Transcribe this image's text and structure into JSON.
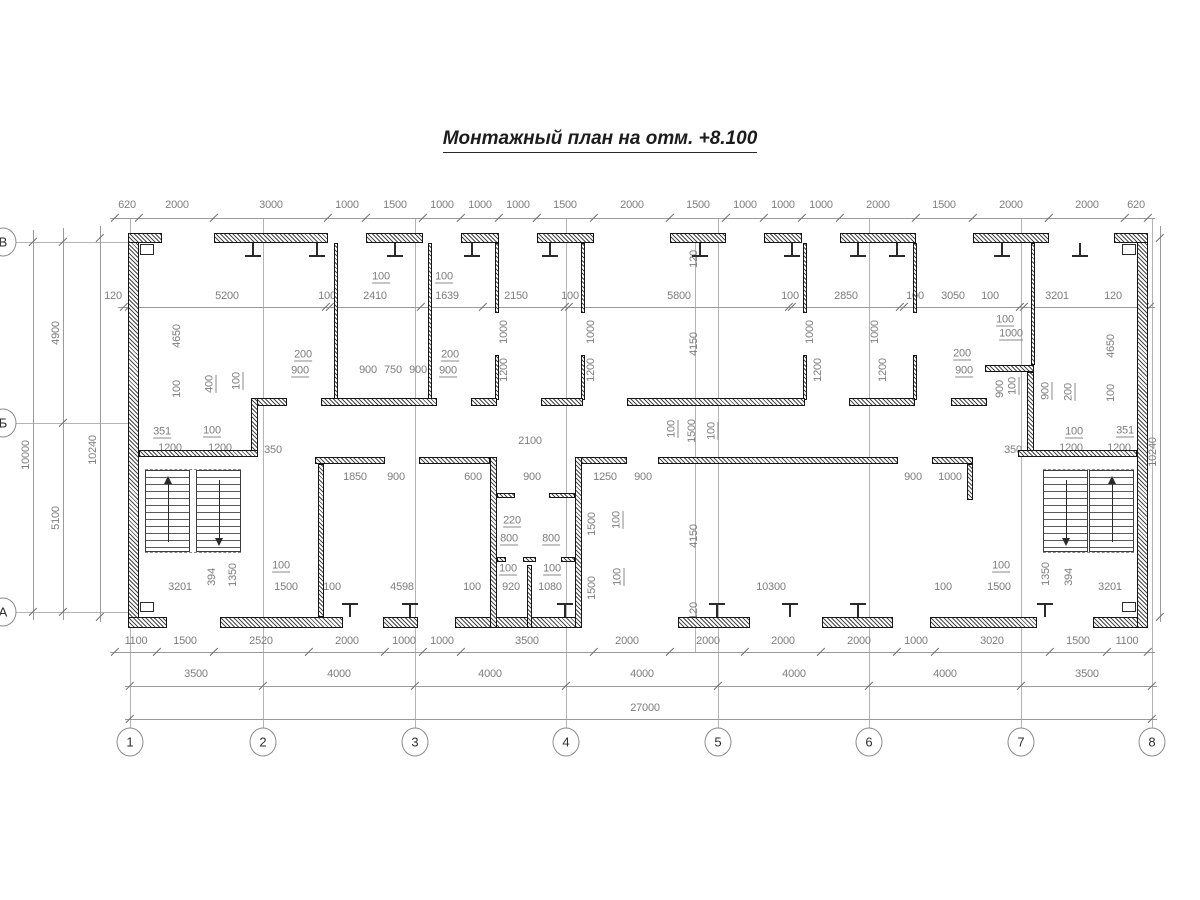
{
  "title": "Монтажный план на отм. +8.100",
  "colors": {
    "dim_text": "#7d7d7d",
    "walls": "#161616",
    "lines": "#9a9a9a",
    "title": "#1c1c1c"
  },
  "axis_bubbles": {
    "columns": [
      {
        "label": "1",
        "x": 130
      },
      {
        "label": "2",
        "x": 263
      },
      {
        "label": "3",
        "x": 415
      },
      {
        "label": "4",
        "x": 566
      },
      {
        "label": "5",
        "x": 718
      },
      {
        "label": "6",
        "x": 869
      },
      {
        "label": "7",
        "x": 1021
      },
      {
        "label": "8",
        "x": 1152
      }
    ],
    "columns_y": 742,
    "rows": [
      {
        "label": "В",
        "y": 242
      },
      {
        "label": "Б",
        "y": 423
      },
      {
        "label": "А",
        "y": 612
      }
    ],
    "rows_x": 3
  },
  "h_chains": [
    {
      "name": "top-panel-dims",
      "line_y": 218,
      "label_y": 205,
      "x1": 110,
      "x2": 1155,
      "ticks": [
        115,
        139,
        214,
        328,
        366,
        423,
        461,
        499,
        537,
        594,
        670,
        726,
        764,
        802,
        840,
        916,
        973,
        1049,
        1125,
        1148
      ],
      "labels": [
        {
          "t": "620",
          "x": 127
        },
        {
          "t": "2000",
          "x": 177
        },
        {
          "t": "3000",
          "x": 271
        },
        {
          "t": "1000",
          "x": 347
        },
        {
          "t": "1500",
          "x": 395
        },
        {
          "t": "1000",
          "x": 442
        },
        {
          "t": "1000",
          "x": 480
        },
        {
          "t": "1000",
          "x": 518
        },
        {
          "t": "1500",
          "x": 565
        },
        {
          "t": "2000",
          "x": 632
        },
        {
          "t": "1500",
          "x": 698
        },
        {
          "t": "1000",
          "x": 745
        },
        {
          "t": "1000",
          "x": 783
        },
        {
          "t": "1000",
          "x": 821
        },
        {
          "t": "2000",
          "x": 878
        },
        {
          "t": "1500",
          "x": 944
        },
        {
          "t": "2000",
          "x": 1011
        },
        {
          "t": "2000",
          "x": 1087
        },
        {
          "t": "620",
          "x": 1136
        }
      ]
    },
    {
      "name": "top-room-dims",
      "line_y": 307,
      "label_y": 296,
      "x1": 118,
      "x2": 1155,
      "ticks": [
        124,
        129,
        326,
        330,
        421,
        483,
        565,
        569,
        789,
        792,
        900,
        904,
        1020,
        1024,
        1145,
        1150
      ],
      "labels": [
        {
          "t": "120",
          "x": 113
        },
        {
          "t": "5200",
          "x": 227
        },
        {
          "t": "100",
          "x": 327
        },
        {
          "t": "2410",
          "x": 375
        },
        {
          "t": "1639",
          "x": 447
        },
        {
          "t": "2150",
          "x": 516
        },
        {
          "t": "100",
          "x": 570
        },
        {
          "t": "5800",
          "x": 679
        },
        {
          "t": "100",
          "x": 790
        },
        {
          "t": "2850",
          "x": 846
        },
        {
          "t": "100",
          "x": 915
        },
        {
          "t": "3050",
          "x": 953
        },
        {
          "t": "100",
          "x": 990
        },
        {
          "t": "3201",
          "x": 1057
        },
        {
          "t": "120",
          "x": 1113
        }
      ]
    },
    {
      "name": "bottom-panel-dims",
      "line_y": 652,
      "label_y": 641,
      "x1": 110,
      "x2": 1155,
      "ticks": [
        115,
        157,
        214,
        309,
        385,
        423,
        461,
        594,
        670,
        745,
        821,
        897,
        935,
        1050,
        1107,
        1148
      ],
      "labels": [
        {
          "t": "1100",
          "x": 136
        },
        {
          "t": "1500",
          "x": 185
        },
        {
          "t": "2520",
          "x": 261
        },
        {
          "t": "2000",
          "x": 347
        },
        {
          "t": "1000",
          "x": 404
        },
        {
          "t": "1000",
          "x": 442
        },
        {
          "t": "3500",
          "x": 527
        },
        {
          "t": "2000",
          "x": 627
        },
        {
          "t": "2000",
          "x": 708
        },
        {
          "t": "2000",
          "x": 783
        },
        {
          "t": "2000",
          "x": 859
        },
        {
          "t": "1000",
          "x": 916
        },
        {
          "t": "3020",
          "x": 992
        },
        {
          "t": "1500",
          "x": 1078
        },
        {
          "t": "1100",
          "x": 1127
        }
      ]
    },
    {
      "name": "axis-span-dims",
      "line_y": 686,
      "label_y": 674,
      "x1": 125,
      "x2": 1157,
      "ticks": [
        130,
        263,
        415,
        566,
        718,
        869,
        1021,
        1152
      ],
      "labels": [
        {
          "t": "3500",
          "x": 196
        },
        {
          "t": "4000",
          "x": 339
        },
        {
          "t": "4000",
          "x": 490
        },
        {
          "t": "4000",
          "x": 642
        },
        {
          "t": "4000",
          "x": 794
        },
        {
          "t": "4000",
          "x": 945
        },
        {
          "t": "3500",
          "x": 1087
        }
      ]
    },
    {
      "name": "overall-dim",
      "line_y": 719,
      "label_y": 708,
      "x1": 125,
      "x2": 1157,
      "ticks": [
        130,
        1152
      ],
      "labels": [
        {
          "t": "27000",
          "x": 645
        }
      ]
    }
  ],
  "v_chains": [
    {
      "name": "left-overall",
      "line_x": 33,
      "y1": 230,
      "y2": 620,
      "ticks": [
        242,
        612
      ],
      "labels": [
        {
          "t": "10000",
          "y": 455
        }
      ]
    },
    {
      "name": "left-axis-spans",
      "line_x": 63,
      "y1": 228,
      "y2": 620,
      "ticks": [
        242,
        423,
        612
      ],
      "labels": [
        {
          "t": "4900",
          "y": 333
        },
        {
          "t": "5100",
          "y": 518
        }
      ]
    },
    {
      "name": "left-inner",
      "line_x": 100,
      "y1": 226,
      "y2": 622,
      "ticks": [
        238,
        617
      ],
      "labels": [
        {
          "t": "10240",
          "y": 450
        }
      ]
    },
    {
      "name": "right-inner",
      "line_x": 1160,
      "y1": 226,
      "y2": 622,
      "ticks": [
        238,
        617
      ],
      "labels": [
        {
          "t": "10240",
          "y": 452
        }
      ]
    }
  ],
  "free_labels": [
    {
      "t": "4650",
      "x": 177,
      "y": 336,
      "r": 1
    },
    {
      "t": "100",
      "x": 177,
      "y": 389,
      "r": 1
    },
    {
      "t": "400",
      "x": 210,
      "y": 384,
      "r": 1,
      "u": 1
    },
    {
      "t": "100",
      "x": 237,
      "y": 381,
      "r": 1,
      "u": 1
    },
    {
      "t": "200",
      "x": 303,
      "y": 355,
      "u": 1
    },
    {
      "t": "900",
      "x": 300,
      "y": 371,
      "u": 1
    },
    {
      "t": "900",
      "x": 368,
      "y": 370
    },
    {
      "t": "750",
      "x": 393,
      "y": 370
    },
    {
      "t": "900",
      "x": 418,
      "y": 370
    },
    {
      "t": "200",
      "x": 450,
      "y": 355,
      "u": 1
    },
    {
      "t": "900",
      "x": 448,
      "y": 371,
      "u": 1
    },
    {
      "t": "100",
      "x": 381,
      "y": 277,
      "u": 1
    },
    {
      "t": "100",
      "x": 444,
      "y": 277,
      "u": 1
    },
    {
      "t": "1000",
      "x": 504,
      "y": 332,
      "r": 1
    },
    {
      "t": "1200",
      "x": 504,
      "y": 370,
      "r": 1
    },
    {
      "t": "1000",
      "x": 591,
      "y": 332,
      "r": 1
    },
    {
      "t": "1200",
      "x": 591,
      "y": 370,
      "r": 1
    },
    {
      "t": "1000",
      "x": 810,
      "y": 332,
      "r": 1
    },
    {
      "t": "1200",
      "x": 818,
      "y": 370,
      "r": 1
    },
    {
      "t": "1000",
      "x": 875,
      "y": 332,
      "r": 1
    },
    {
      "t": "1200",
      "x": 883,
      "y": 370,
      "r": 1
    },
    {
      "t": "120",
      "x": 694,
      "y": 259,
      "r": 1
    },
    {
      "t": "4150",
      "x": 694,
      "y": 344,
      "r": 1
    },
    {
      "t": "100",
      "x": 672,
      "y": 429,
      "r": 1,
      "u": 1
    },
    {
      "t": "1500",
      "x": 692,
      "y": 431,
      "r": 1
    },
    {
      "t": "100",
      "x": 712,
      "y": 431,
      "r": 1,
      "u": 1
    },
    {
      "t": "100",
      "x": 1005,
      "y": 320,
      "u": 1
    },
    {
      "t": "1000",
      "x": 1011,
      "y": 334,
      "u": 1
    },
    {
      "t": "200",
      "x": 962,
      "y": 354,
      "u": 1
    },
    {
      "t": "900",
      "x": 964,
      "y": 371,
      "u": 1
    },
    {
      "t": "900",
      "x": 1000,
      "y": 389,
      "r": 1
    },
    {
      "t": "100",
      "x": 1013,
      "y": 386,
      "r": 1,
      "u": 1
    },
    {
      "t": "900",
      "x": 1046,
      "y": 391,
      "r": 1,
      "u": 1
    },
    {
      "t": "200",
      "x": 1069,
      "y": 392,
      "r": 1,
      "u": 1
    },
    {
      "t": "4650",
      "x": 1111,
      "y": 346,
      "r": 1
    },
    {
      "t": "100",
      "x": 1111,
      "y": 393,
      "r": 1
    },
    {
      "t": "351",
      "x": 162,
      "y": 432,
      "u": 1
    },
    {
      "t": "100",
      "x": 212,
      "y": 431,
      "u": 1
    },
    {
      "t": "1200",
      "x": 170,
      "y": 448
    },
    {
      "t": "1200",
      "x": 220,
      "y": 448
    },
    {
      "t": "350",
      "x": 273,
      "y": 450
    },
    {
      "t": "100",
      "x": 1074,
      "y": 432,
      "u": 1
    },
    {
      "t": "351",
      "x": 1125,
      "y": 431,
      "u": 1
    },
    {
      "t": "1200",
      "x": 1071,
      "y": 448
    },
    {
      "t": "1200",
      "x": 1119,
      "y": 448
    },
    {
      "t": "350",
      "x": 1013,
      "y": 450
    },
    {
      "t": "2100",
      "x": 530,
      "y": 441
    },
    {
      "t": "1850",
      "x": 355,
      "y": 477
    },
    {
      "t": "900",
      "x": 396,
      "y": 477
    },
    {
      "t": "600",
      "x": 473,
      "y": 477
    },
    {
      "t": "900",
      "x": 532,
      "y": 477
    },
    {
      "t": "1250",
      "x": 605,
      "y": 477
    },
    {
      "t": "900",
      "x": 643,
      "y": 477
    },
    {
      "t": "900",
      "x": 913,
      "y": 477
    },
    {
      "t": "1000",
      "x": 950,
      "y": 477
    },
    {
      "t": "220",
      "x": 512,
      "y": 521,
      "u": 1
    },
    {
      "t": "800",
      "x": 509,
      "y": 539,
      "u": 1
    },
    {
      "t": "800",
      "x": 551,
      "y": 539,
      "u": 1
    },
    {
      "t": "100",
      "x": 508,
      "y": 569,
      "u": 1
    },
    {
      "t": "100",
      "x": 552,
      "y": 569,
      "u": 1
    },
    {
      "t": "1500",
      "x": 592,
      "y": 524,
      "r": 1
    },
    {
      "t": "100",
      "x": 617,
      "y": 520,
      "r": 1,
      "u": 1
    },
    {
      "t": "1500",
      "x": 592,
      "y": 588,
      "r": 1
    },
    {
      "t": "100",
      "x": 618,
      "y": 577,
      "r": 1,
      "u": 1
    },
    {
      "t": "4150",
      "x": 694,
      "y": 536,
      "r": 1
    },
    {
      "t": "3201",
      "x": 180,
      "y": 587
    },
    {
      "t": "394",
      "x": 212,
      "y": 577,
      "r": 1
    },
    {
      "t": "1350",
      "x": 233,
      "y": 575,
      "r": 1
    },
    {
      "t": "100",
      "x": 281,
      "y": 566,
      "u": 1
    },
    {
      "t": "1500",
      "x": 286,
      "y": 587
    },
    {
      "t": "100",
      "x": 332,
      "y": 587
    },
    {
      "t": "4598",
      "x": 402,
      "y": 587
    },
    {
      "t": "100",
      "x": 472,
      "y": 587
    },
    {
      "t": "920",
      "x": 511,
      "y": 587
    },
    {
      "t": "1080",
      "x": 550,
      "y": 587
    },
    {
      "t": "120",
      "x": 694,
      "y": 611,
      "r": 1
    },
    {
      "t": "10300",
      "x": 771,
      "y": 587
    },
    {
      "t": "100",
      "x": 943,
      "y": 587
    },
    {
      "t": "1500",
      "x": 999,
      "y": 587
    },
    {
      "t": "100",
      "x": 1001,
      "y": 566,
      "u": 1
    },
    {
      "t": "1350",
      "x": 1046,
      "y": 574,
      "r": 1
    },
    {
      "t": "394",
      "x": 1069,
      "y": 577,
      "r": 1
    },
    {
      "t": "3201",
      "x": 1110,
      "y": 587
    }
  ],
  "walls": [
    {
      "x": 128,
      "y": 233,
      "w": 11,
      "h": 395
    },
    {
      "x": 1137,
      "y": 233,
      "w": 11,
      "h": 395
    },
    {
      "x": 128,
      "y": 233,
      "w": 34,
      "h": 10
    },
    {
      "x": 214,
      "y": 233,
      "w": 114,
      "h": 10
    },
    {
      "x": 366,
      "y": 233,
      "w": 57,
      "h": 10
    },
    {
      "x": 461,
      "y": 233,
      "w": 38,
      "h": 10
    },
    {
      "x": 537,
      "y": 233,
      "w": 57,
      "h": 10
    },
    {
      "x": 670,
      "y": 233,
      "w": 56,
      "h": 10
    },
    {
      "x": 764,
      "y": 233,
      "w": 38,
      "h": 10
    },
    {
      "x": 840,
      "y": 233,
      "w": 76,
      "h": 10
    },
    {
      "x": 973,
      "y": 233,
      "w": 76,
      "h": 10
    },
    {
      "x": 1114,
      "y": 233,
      "w": 34,
      "h": 10
    },
    {
      "x": 128,
      "y": 617,
      "w": 39,
      "h": 11
    },
    {
      "x": 220,
      "y": 617,
      "w": 123,
      "h": 11
    },
    {
      "x": 383,
      "y": 617,
      "w": 35,
      "h": 11
    },
    {
      "x": 455,
      "y": 617,
      "w": 122,
      "h": 11
    },
    {
      "x": 678,
      "y": 617,
      "w": 72,
      "h": 11
    },
    {
      "x": 822,
      "y": 617,
      "w": 71,
      "h": 11
    },
    {
      "x": 930,
      "y": 617,
      "w": 107,
      "h": 11
    },
    {
      "x": 1093,
      "y": 617,
      "w": 45,
      "h": 11
    },
    {
      "x": 334,
      "y": 243,
      "w": 4,
      "h": 157
    },
    {
      "x": 428,
      "y": 243,
      "w": 4,
      "h": 157
    },
    {
      "x": 495,
      "y": 243,
      "w": 4,
      "h": 70
    },
    {
      "x": 495,
      "y": 355,
      "w": 4,
      "h": 45
    },
    {
      "x": 581,
      "y": 243,
      "w": 4,
      "h": 70
    },
    {
      "x": 581,
      "y": 355,
      "w": 4,
      "h": 45
    },
    {
      "x": 803,
      "y": 243,
      "w": 4,
      "h": 70
    },
    {
      "x": 803,
      "y": 355,
      "w": 4,
      "h": 45
    },
    {
      "x": 913,
      "y": 243,
      "w": 4,
      "h": 70
    },
    {
      "x": 913,
      "y": 355,
      "w": 4,
      "h": 45
    },
    {
      "x": 1031,
      "y": 243,
      "w": 4,
      "h": 122
    },
    {
      "x": 253,
      "y": 398,
      "w": 34,
      "h": 8
    },
    {
      "x": 321,
      "y": 398,
      "w": 116,
      "h": 8
    },
    {
      "x": 471,
      "y": 398,
      "w": 26,
      "h": 8
    },
    {
      "x": 541,
      "y": 398,
      "w": 42,
      "h": 8
    },
    {
      "x": 627,
      "y": 398,
      "w": 178,
      "h": 8
    },
    {
      "x": 849,
      "y": 398,
      "w": 66,
      "h": 8
    },
    {
      "x": 951,
      "y": 398,
      "w": 36,
      "h": 8
    },
    {
      "x": 985,
      "y": 365,
      "w": 49,
      "h": 7
    },
    {
      "x": 1027,
      "y": 372,
      "w": 7,
      "h": 85
    },
    {
      "x": 251,
      "y": 398,
      "w": 7,
      "h": 59
    },
    {
      "x": 139,
      "y": 450,
      "w": 119,
      "h": 7
    },
    {
      "x": 1018,
      "y": 450,
      "w": 119,
      "h": 7
    },
    {
      "x": 315,
      "y": 457,
      "w": 70,
      "h": 7
    },
    {
      "x": 419,
      "y": 457,
      "w": 71,
      "h": 7
    },
    {
      "x": 577,
      "y": 457,
      "w": 50,
      "h": 7
    },
    {
      "x": 658,
      "y": 457,
      "w": 240,
      "h": 7
    },
    {
      "x": 932,
      "y": 457,
      "w": 41,
      "h": 7
    },
    {
      "x": 967,
      "y": 464,
      "w": 6,
      "h": 36
    },
    {
      "x": 490,
      "y": 457,
      "w": 7,
      "h": 171
    },
    {
      "x": 575,
      "y": 457,
      "w": 7,
      "h": 171
    },
    {
      "x": 497,
      "y": 493,
      "w": 18,
      "h": 5
    },
    {
      "x": 549,
      "y": 493,
      "w": 26,
      "h": 5
    },
    {
      "x": 497,
      "y": 557,
      "w": 9,
      "h": 5
    },
    {
      "x": 523,
      "y": 557,
      "w": 13,
      "h": 5
    },
    {
      "x": 561,
      "y": 557,
      "w": 14,
      "h": 5
    },
    {
      "x": 527,
      "y": 565,
      "w": 5,
      "h": 63
    },
    {
      "x": 318,
      "y": 464,
      "w": 6,
      "h": 153
    }
  ],
  "white_notches": [
    {
      "x": 140,
      "y": 244,
      "w": 14,
      "h": 11
    },
    {
      "x": 1122,
      "y": 244,
      "w": 14,
      "h": 11
    },
    {
      "x": 140,
      "y": 602,
      "w": 14,
      "h": 10
    },
    {
      "x": 1122,
      "y": 602,
      "w": 14,
      "h": 10
    }
  ],
  "ibeams_top": [
    253,
    317,
    395,
    472,
    550,
    700,
    792,
    858,
    897,
    1002,
    1080
  ],
  "ibeams_bottom": [
    350,
    410,
    565,
    717,
    790,
    858,
    1045
  ],
  "stairs": [
    {
      "name": "left-stair",
      "dash_x1": 145,
      "dash_x2": 241,
      "y": 470,
      "h": 82,
      "flights": [
        {
          "x": 145,
          "w": 45,
          "arrow": "up"
        },
        {
          "x": 196,
          "w": 45,
          "arrow": "down"
        }
      ]
    },
    {
      "name": "right-stair",
      "dash_x1": 1043,
      "dash_x2": 1134,
      "y": 470,
      "h": 82,
      "flights": [
        {
          "x": 1043,
          "w": 45,
          "arrow": "down"
        },
        {
          "x": 1089,
          "w": 45,
          "arrow": "up"
        }
      ]
    }
  ],
  "ext_lines": {
    "columns_y1": 218,
    "columns_y2": 728,
    "rows_x1": 16,
    "rows_x2": 128,
    "extra_vertical": {
      "x": 695,
      "y1": 243,
      "y2": 652
    }
  }
}
